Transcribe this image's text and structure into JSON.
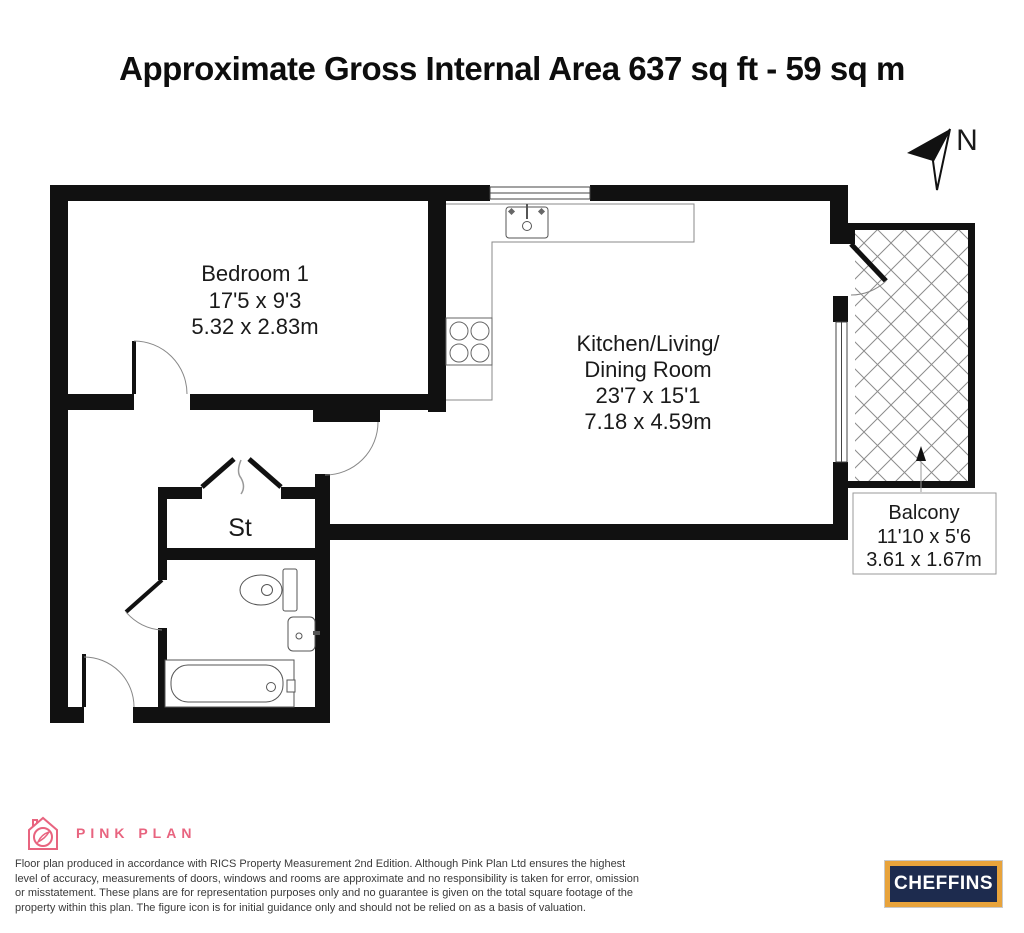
{
  "title": "Approximate Gross Internal Area 637 sq ft - 59 sq m",
  "compass": {
    "label": "N"
  },
  "rooms": {
    "bedroom": {
      "name": "Bedroom 1",
      "imperial": "17'5 x 9'3",
      "metric": "5.32 x 2.83m"
    },
    "kitchen": {
      "name_line1": "Kitchen/Living/",
      "name_line2": "Dining Room",
      "imperial": "23'7 x 15'1",
      "metric": "7.18 x 4.59m"
    },
    "storage": {
      "name": "St"
    },
    "balcony": {
      "name": "Balcony",
      "imperial": "11'10 x 5'6",
      "metric": "3.61 x 1.67m"
    }
  },
  "footer": {
    "brand": "PINK PLAN",
    "disclaimer": "Floor plan produced in accordance with RICS Property Measurement 2nd Edition. Although Pink Plan Ltd ensures the highest level of accuracy, measurements of doors, windows and rooms are approximate and no responsibility is taken for error, omission or misstatement. These plans are for representation purposes only and no guarantee is given on the total square footage of the property within this plan. The figure icon is for initial guidance only and should not be relied on as a basis of valuation.",
    "agent_logo": "CHEFFINS"
  },
  "colors": {
    "wall": "#111111",
    "brand_pink": "#e8647f",
    "cheffins_navy": "#1d2b4e",
    "cheffins_gold": "#e8a33b"
  }
}
